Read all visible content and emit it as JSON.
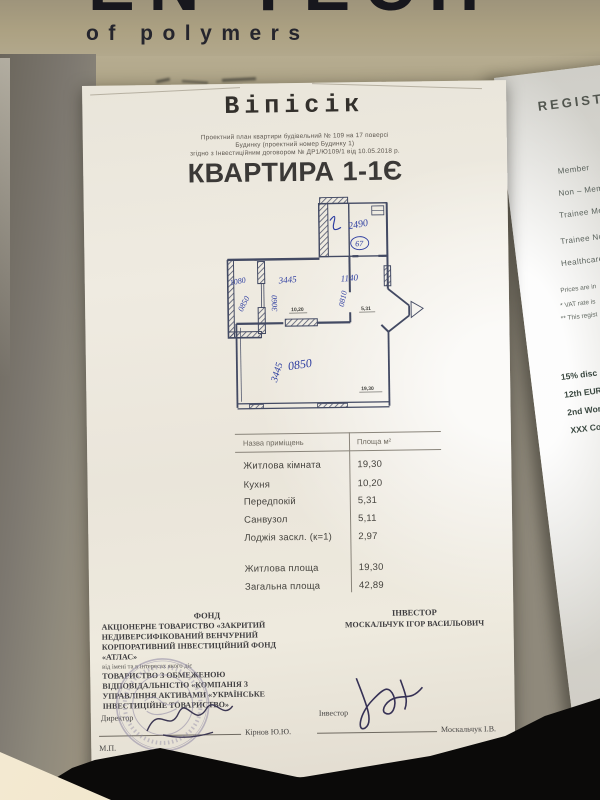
{
  "banner": {
    "big_text": "EN TECH",
    "subtitle": "of polymers"
  },
  "document": {
    "logo": "Віпісік",
    "subtitle_lines": [
      "Проектний план квартири будівельний № 109 на 17 поверсі",
      "Будинку (проектний номер Будинку 1)",
      "згідно з Інвестиційним договором № ДР1/Ю109/1 від 10.05.2018 р."
    ],
    "title": "КВАРТИРА 1-1Є",
    "plan": {
      "handwritten": {
        "top_room": "2490",
        "circled": "67",
        "width_kitchen": "3445",
        "width_hall": "1140",
        "loggia_top": "1080",
        "loggia_diag": "0850",
        "kitchen_vert": "3060",
        "hall_diag": "0810",
        "living_width": "0850",
        "living_height": "3445"
      },
      "printed": {
        "kitchen": "10,20",
        "hall": "5,31",
        "living": "19,30"
      }
    },
    "table": {
      "headers": [
        "Назва приміщень",
        "Площа м²"
      ],
      "rows": [
        [
          "Житлова кімната",
          "19,30"
        ],
        [
          "Кухня",
          "10,20"
        ],
        [
          "Передпокій",
          "5,31"
        ],
        [
          "Санвузол",
          "5,11"
        ],
        [
          "Лоджія заскл. (к=1)",
          "2,97"
        ]
      ],
      "totals": [
        [
          "Житлова площа",
          "19,30"
        ],
        [
          "Загальна площа",
          "42,89"
        ]
      ]
    },
    "fund": {
      "heading": "ФОНД",
      "lines1": [
        "АКЦІОНЕРНЕ ТОВАРИСТВО «ЗАКРИТИЙ",
        "НЕДИВЕРСИФІКОВАНИЙ ВЕНЧУРНИЙ",
        "КОРПОРАТИВНИЙ ІНВЕСТИЦІЙНИЙ ФОНД",
        "«АТЛАС»"
      ],
      "intermediate": "від імені та в інтересах якого діє",
      "lines2": [
        "ТОВАРИСТВО З ОБМЕЖЕНОЮ",
        "ВІДПОВІДАЛЬНІСТЮ «КОМПАНІЯ З",
        "УПРАВЛІННЯ АКТИВАМИ «УКРАЇНСЬКЕ",
        "ІНВЕСТИЦІЙНЕ ТОВАРИСТВО»"
      ],
      "signer_role": "Директор",
      "signer_name": "Кірнов Ю.Ю.",
      "seal_mark": "М.П."
    },
    "investor": {
      "heading": "ІНВЕСТОР",
      "name": "МОСКАЛЬЧУК ІГОР ВАСИЛЬОВИЧ",
      "signer_role": "Інвестор",
      "signer_name": "Москальчук І.В."
    }
  },
  "right_page": {
    "title": "REGISTRA",
    "items": [
      "Member",
      "Non – Member",
      "Trainee Member",
      "Trainee Non-Me",
      "Healthcare Pro"
    ],
    "notes": [
      "Prices are in",
      "* VAT rate is",
      "** This regist"
    ],
    "events": [
      "15% disc",
      "12th EUR",
      "2nd Wor",
      "XXX Co"
    ],
    "footer": "It is ad",
    "website": "WW"
  }
}
